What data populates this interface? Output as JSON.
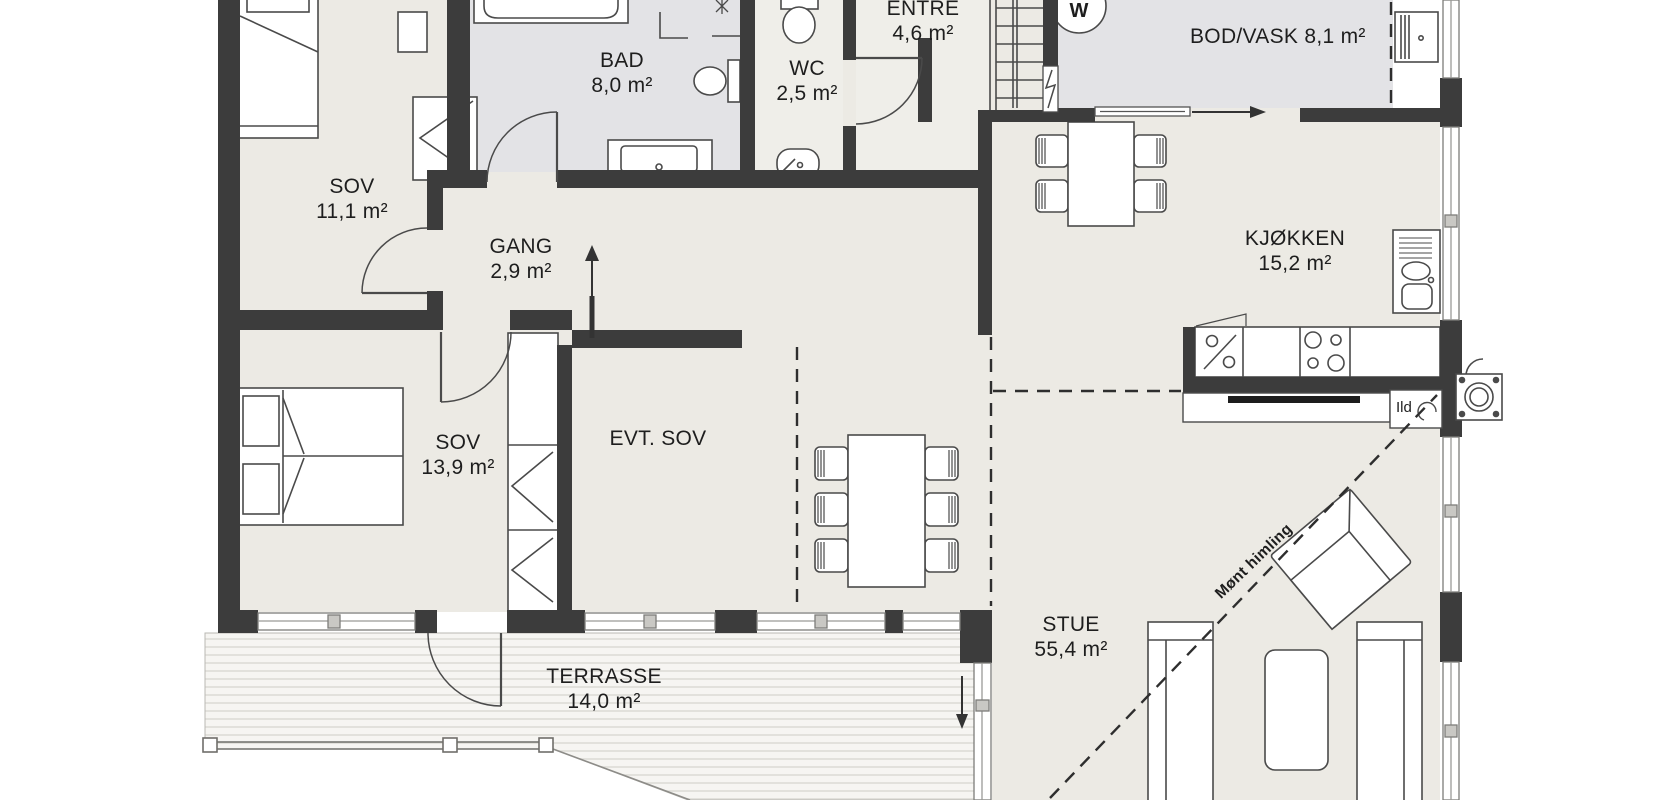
{
  "plan": {
    "type": "architectural-floor-plan",
    "rooms": [
      {
        "name": "SOV",
        "area": "11,1 m²"
      },
      {
        "name": "BAD",
        "area": "8,0 m²"
      },
      {
        "name": "WC",
        "area": "2,5 m²"
      },
      {
        "name": "ENTRE",
        "area": "4,6 m²"
      },
      {
        "name": "BOD/VASK",
        "area": "8,1 m²"
      },
      {
        "name": "KJØKKEN",
        "area": "15,2 m²"
      },
      {
        "name": "GANG",
        "area": "2,9 m²"
      },
      {
        "name": "SOV",
        "area": "13,9 m²"
      },
      {
        "name": "EVT. SOV",
        "area": ""
      },
      {
        "name": "STUE",
        "area": "55,4 m²"
      },
      {
        "name": "TERRASSE",
        "area": "14,0 m²"
      }
    ],
    "annotations": {
      "fireplace_label": "Ild",
      "ridge_label": "Mønt himling",
      "washer_label": "W"
    },
    "colors": {
      "wall": "#3c3c3c",
      "floor_main": "#eceae4",
      "floor_wet": "#e3e3e6",
      "floor_light": "#efeee9",
      "deck_stripe": "#dddcd7"
    }
  }
}
